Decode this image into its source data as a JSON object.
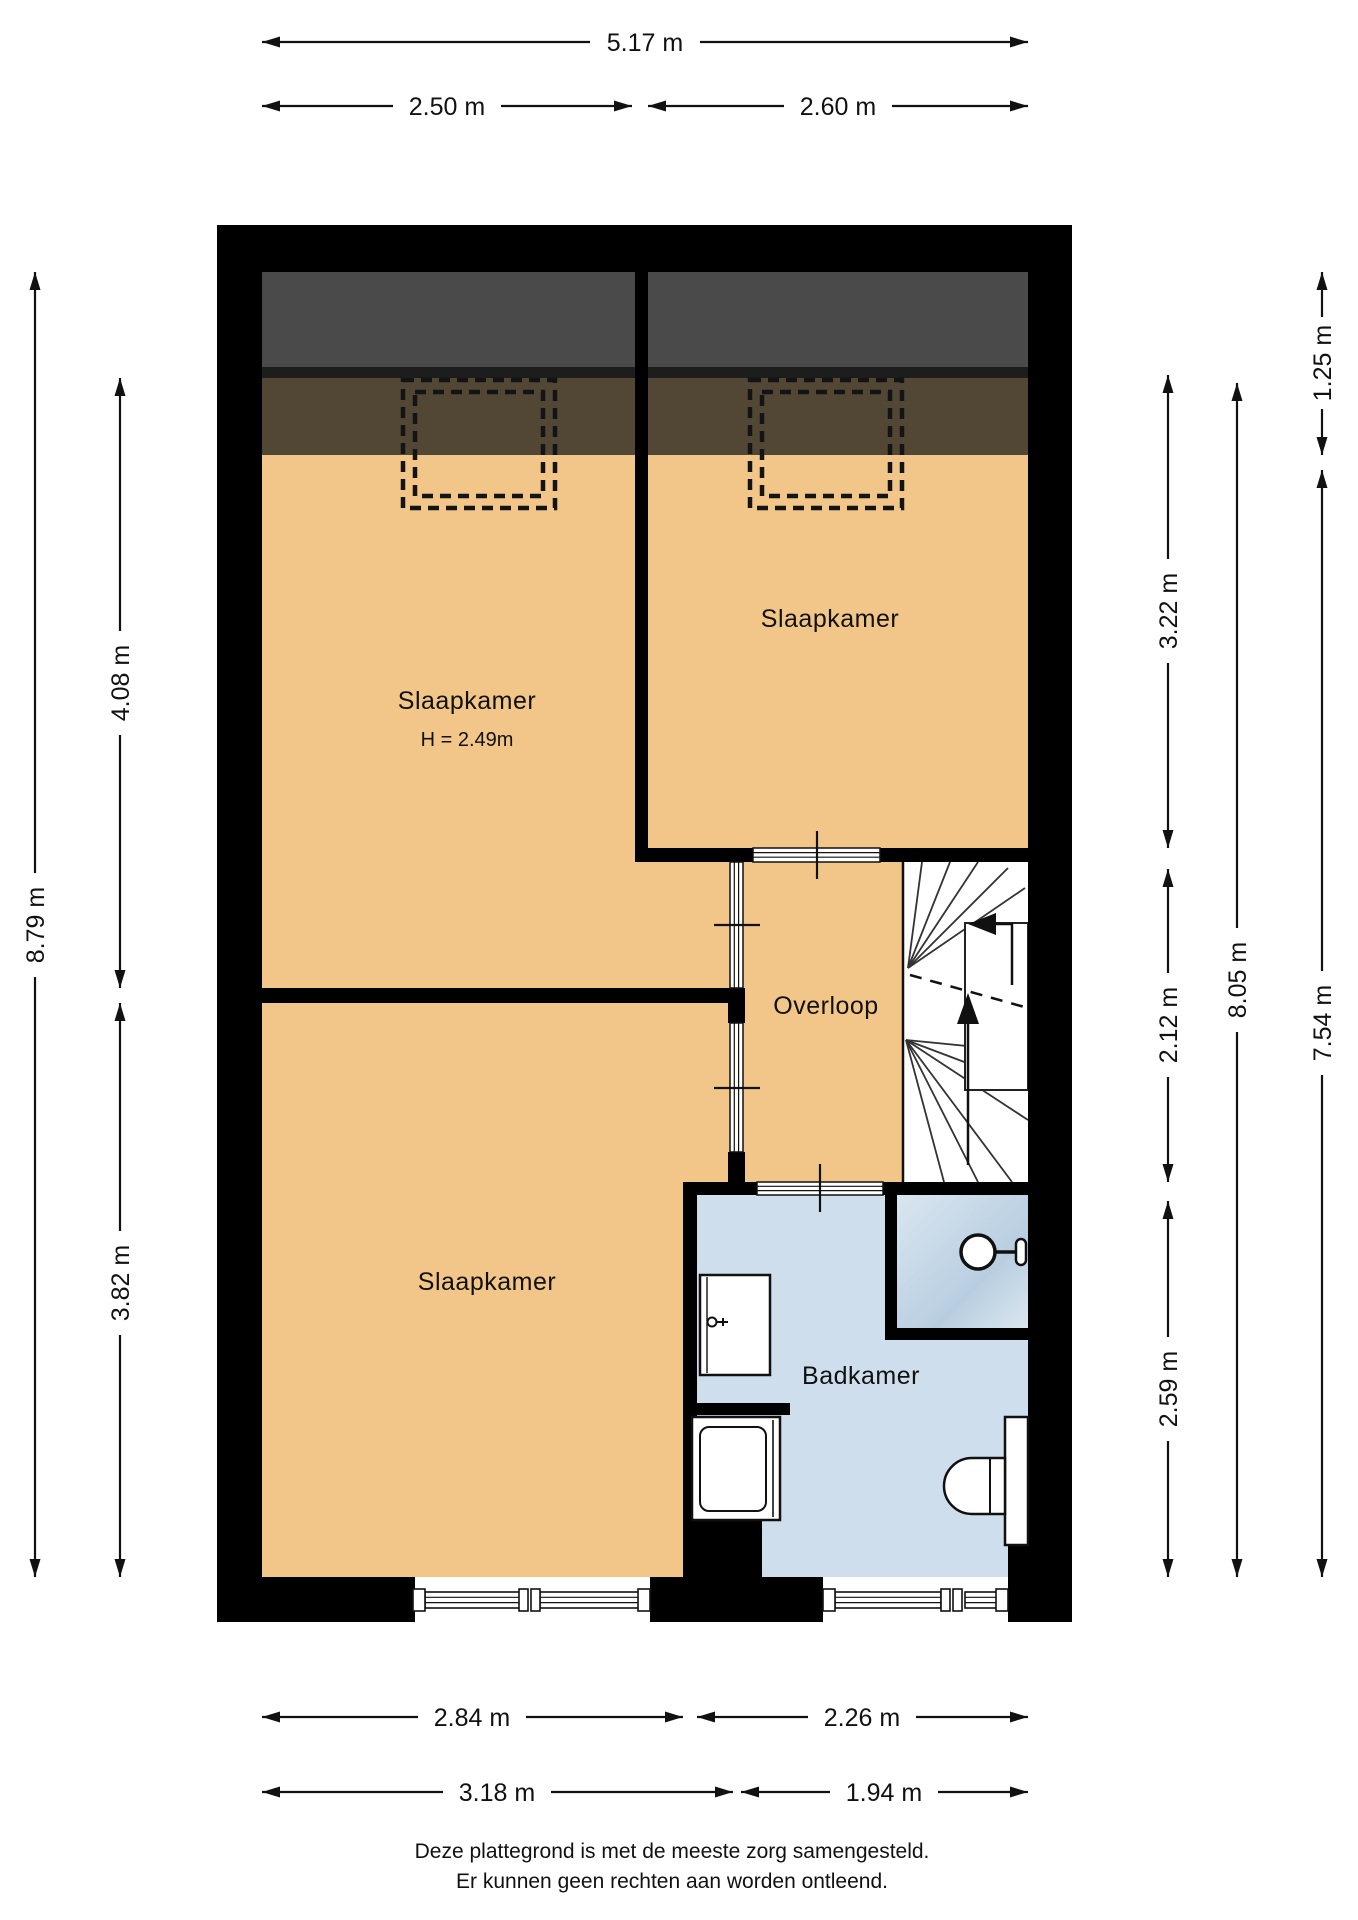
{
  "rooms": {
    "bedroom_top_left": {
      "label": "Slaapkamer",
      "height_note": "H = 2.49m"
    },
    "bedroom_top_right": {
      "label": "Slaapkamer"
    },
    "bedroom_bottom_left": {
      "label": "Slaapkamer"
    },
    "landing": {
      "label": "Overloop"
    },
    "bathroom": {
      "label": "Badkamer"
    }
  },
  "dims": {
    "w_total": "5.17 m",
    "w_left": "2.50 m",
    "w_right": "2.60 m",
    "b_bedroom": "2.84 m",
    "b_bathroom": "2.26 m",
    "b_left2": "3.18 m",
    "b_right2": "1.94 m",
    "l_total": "8.79 m",
    "l_top": "4.08 m",
    "l_bottom": "3.82 m",
    "r_roof": "1.25 m",
    "r_top": "3.22 m",
    "r_mid": "2.12 m",
    "r_bottom": "2.59 m",
    "r_inner_total": "8.05 m",
    "r_outer": "7.54 m"
  },
  "footer": {
    "line1": "Deze plattegrond is met de meeste zorg samengesteld.",
    "line2": "Er kunnen geen rechten aan worden ontleend."
  },
  "colors": {
    "wall": "#000000",
    "floor": "#f2c688",
    "attic_band": "#524634",
    "roof_band": "#4a4a4a",
    "bathroom_floor": "#cfdeec",
    "shower_dark": "#c2d5e6",
    "shower_light": "#dae6f0"
  }
}
